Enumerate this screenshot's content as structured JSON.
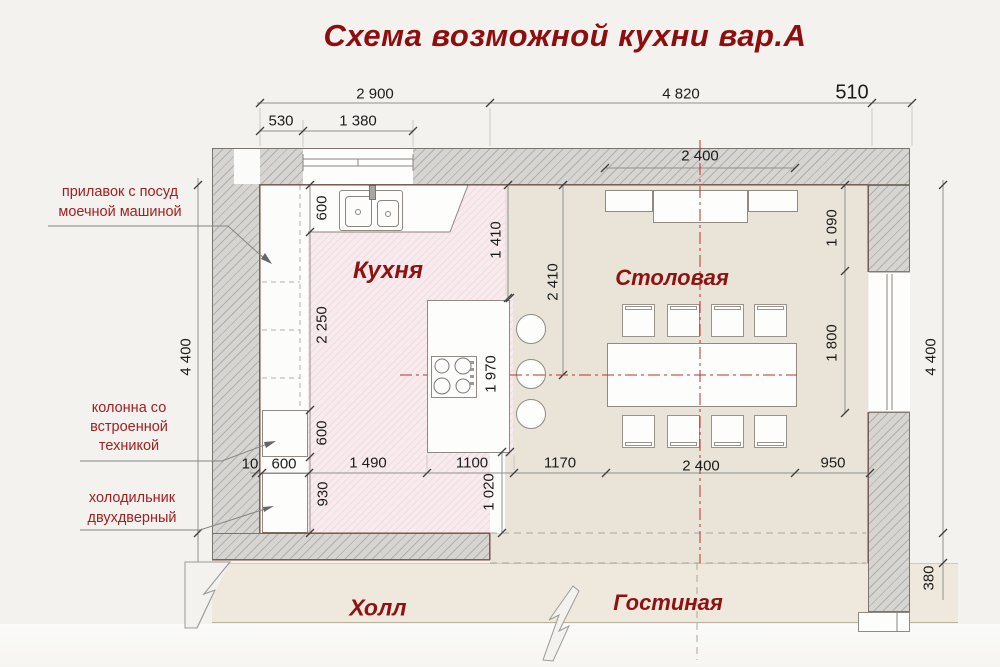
{
  "title": "Схема возможной кухни вар.А",
  "rooms": {
    "kitchen": "Кухня",
    "dining": "Столовая",
    "hall": "Холл",
    "living": "Гостиная"
  },
  "annotations": {
    "counter": {
      "line1": "прилавок с посуд",
      "line2": "моечной машиной"
    },
    "column": {
      "line1": "колонна со",
      "line2": "встроенной",
      "line3": "техникой"
    },
    "fridge": {
      "line1": "холодильник",
      "line2": "двухдверный"
    }
  },
  "dimensions": {
    "kitchen_width_total": "2 900",
    "dining_width_total": "4 820",
    "right_wall_thickness": "510",
    "window_offset": "530",
    "window_width": "1 380",
    "niche_width": "2 400",
    "room_height_left": "4 400",
    "room_height_right": "4 400",
    "right_opening": "380",
    "counter_depth": "600",
    "counter_run": "2 250",
    "column_depth": "600",
    "fridge_zone": "930",
    "kitchen_gap": "1 410",
    "dining_depth": "2 410",
    "island_length": "1 970",
    "sideboard_zone": "1 090",
    "table_zone": "1 800",
    "passage": "1 020",
    "gap_small": "10",
    "fridge_width": "600",
    "counter_width": "1 490",
    "island_width": "1100",
    "aisle_width": "1170",
    "table_width": "2 400",
    "right_margin": "950"
  },
  "colors": {
    "accent_red": "#8e1212",
    "annotation_red": "#a32020",
    "kitchen_pink": "#f8ebee",
    "floor_beige": "#e9e4d7"
  }
}
